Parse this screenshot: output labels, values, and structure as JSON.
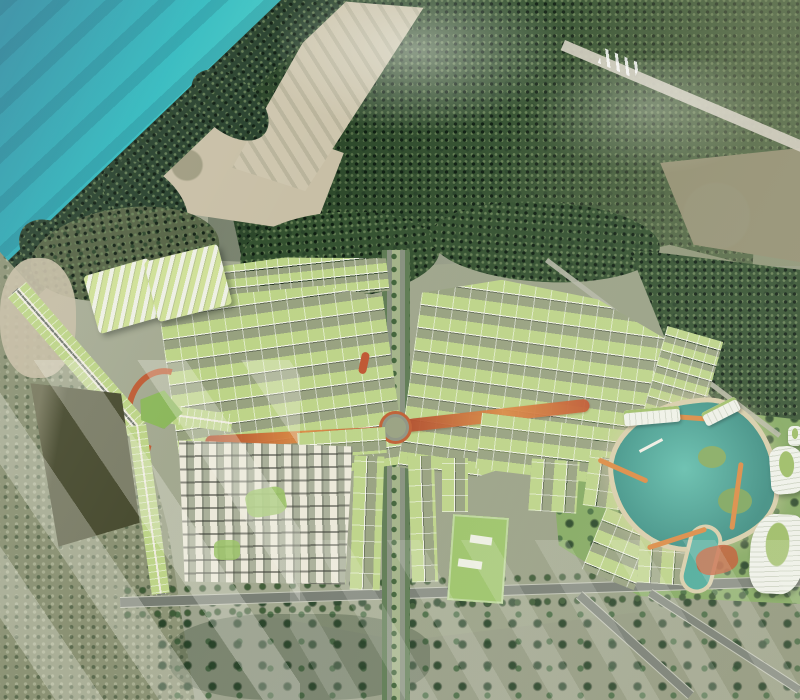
{
  "scene": {
    "type": "aerial-architectural-render",
    "features": [
      "ocean",
      "beach",
      "coastal-forest",
      "cleared-sand",
      "runway-strip",
      "dense-forest",
      "tan-field",
      "masterplan-development",
      "terraced-condos",
      "townhouse-row-fans",
      "central-boulevard",
      "roundabout",
      "red-linear-park",
      "villa-grid",
      "clubhouse",
      "shophouse-rows",
      "green-park-block",
      "lagoon",
      "pier",
      "resort-towers",
      "road-network",
      "scattered-trees",
      "haze-streaks"
    ]
  },
  "palette": {
    "ocean-deep": "#2a8ba0",
    "ocean-mid": "#30b9be",
    "ocean-shallow": "#4fd2ca",
    "ocean-foam": "#9ceade",
    "sand-beach": "#dbd2bd",
    "sand-clear": "#c8bfa6",
    "sand-road": "#d3cec0",
    "forest-dark": "#27402c",
    "forest-mid": "#33502f",
    "forest-olive": "#556344",
    "forest-pale": "#8b9274",
    "field-tan": "#949072",
    "field-dark": "#4a4d32",
    "ground": "#a9ae97",
    "ground-dark": "#91997e",
    "road-gray": "#767c72",
    "road-light": "#c2c5b6",
    "roof-green": "#bdd488",
    "roof-gap": "#97a17f",
    "facade-white": "#f2f4e6",
    "lawn": "#8cb85c",
    "lawn-bright": "#9cc468",
    "park-green": "#83a95f",
    "path-red": "#c2552d",
    "path-orange": "#dd8a42",
    "lagoon-teal": "#4aab9b",
    "lagoon-deep": "#388b80",
    "sand-rim": "#dacfab",
    "slab-white": "#f1f3ea",
    "haze-white": "#f2f2e8"
  }
}
